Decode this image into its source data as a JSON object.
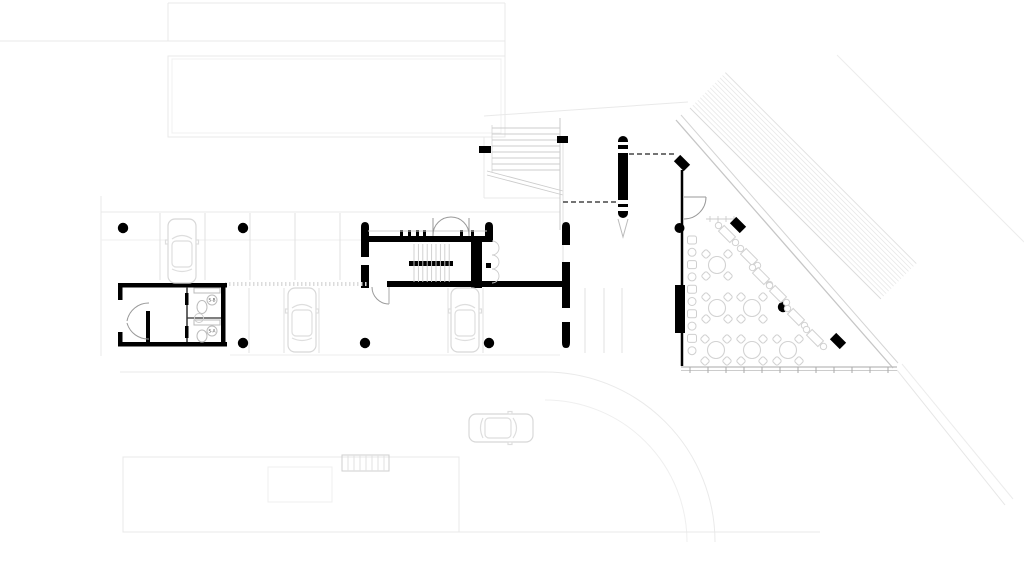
{
  "title": "ground-floor-plan",
  "colors": {
    "wall_black": "#000000",
    "context_light": "#e9e9e9",
    "context_mid": "#d9d9d9",
    "furniture_gray": "#d2d2d2",
    "dashed_line": "#222222",
    "paper": "#ffffff"
  },
  "wc": {
    "stalls": [
      {
        "label": "S-B"
      },
      {
        "label": "S-A"
      }
    ]
  },
  "columns": {
    "round": [
      [
        123,
        228
      ],
      [
        243,
        228
      ],
      [
        243,
        343
      ],
      [
        365,
        343
      ],
      [
        489,
        343
      ],
      [
        783,
        307
      ]
    ],
    "diamond": [
      [
        682,
        163
      ],
      [
        738,
        225
      ],
      [
        838,
        341
      ]
    ]
  },
  "parking": {
    "cars": [
      {
        "x": 182,
        "y": 251,
        "rot": 0
      },
      {
        "x": 302,
        "y": 320,
        "rot": 0
      },
      {
        "x": 465,
        "y": 320,
        "rot": 0
      },
      {
        "x": 501,
        "y": 428,
        "rot": 90
      }
    ],
    "bays": [
      {
        "x": 160,
        "y1": 213,
        "y2": 280
      },
      {
        "x": 205,
        "y1": 213,
        "y2": 280
      },
      {
        "x": 250,
        "y1": 213,
        "y2": 280
      },
      {
        "x": 295,
        "y1": 213,
        "y2": 280
      },
      {
        "x": 340,
        "y1": 213,
        "y2": 280
      },
      {
        "x": 249,
        "y1": 288,
        "y2": 353
      },
      {
        "x": 284,
        "y1": 288,
        "y2": 353
      },
      {
        "x": 319,
        "y1": 288,
        "y2": 353
      },
      {
        "x": 448,
        "y1": 288,
        "y2": 353
      },
      {
        "x": 483,
        "y1": 288,
        "y2": 353
      },
      {
        "x": 585,
        "y1": 288,
        "y2": 353
      },
      {
        "x": 604,
        "y1": 288,
        "y2": 353
      },
      {
        "x": 622,
        "y1": 288,
        "y2": 353
      }
    ]
  },
  "cafe": {
    "round_tables": [
      [
        717,
        265
      ],
      [
        717,
        308
      ],
      [
        716,
        350
      ],
      [
        752,
        308
      ],
      [
        752,
        350
      ],
      [
        788,
        350
      ]
    ],
    "diag_tables": [
      [
        727,
        234
      ],
      [
        749,
        257
      ],
      [
        761,
        276
      ],
      [
        778,
        294
      ],
      [
        796,
        317
      ],
      [
        815,
        338
      ]
    ],
    "stools": {
      "x": 692,
      "y_start": 240,
      "step": 12.3,
      "count": 10
    },
    "edge_ticks": {
      "y": 367,
      "x_start": 690,
      "step": 18,
      "count": 12
    }
  }
}
